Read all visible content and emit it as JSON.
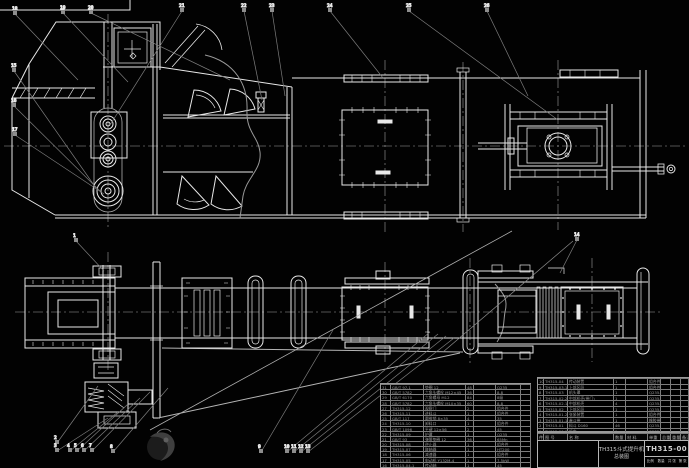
{
  "colors": {
    "background": "#020202",
    "line": "#e8e8e8",
    "dim_line": "#8a8a8a",
    "table_line": "#9a9a9a",
    "text": "#9c9c9c"
  },
  "title_block": {
    "title_line1": "TH315斗式提升机",
    "title_line2": "总装图",
    "drawing_number": "TH315-00",
    "sub_labels": [
      "比例",
      "数量",
      "共 张",
      "第 张"
    ],
    "sig_labels": [
      "标记",
      "设计",
      "制图",
      "审核",
      "处数"
    ]
  },
  "bom_right": {
    "headers": [
      "件",
      "图  号",
      "名    称",
      "数量",
      "材 料",
      "单重",
      "总重",
      "重量",
      "备注"
    ],
    "rows": [
      [
        "10",
        "TH315-04",
        "传动装置",
        "1",
        "",
        "组合件",
        "",
        "",
        ""
      ],
      [
        "9",
        "TH315-03.1",
        "上部区段",
        "1",
        "",
        "组合件",
        "",
        "",
        ""
      ],
      [
        "8",
        "TH315-03",
        "机头罩",
        "1",
        "",
        "Q235-A",
        "",
        "",
        ""
      ],
      [
        "7",
        "TH315-02.2",
        "中部机壳(带门)",
        "1",
        "",
        "Q235-A",
        "",
        "",
        ""
      ],
      [
        "6",
        "TH315-02.1",
        "中部机壳",
        "4",
        "",
        "Q235-A",
        "",
        "",
        ""
      ],
      [
        "5",
        "TH315-02",
        "下部区段",
        "1",
        "",
        "Q235-A",
        "",
        "",
        ""
      ],
      [
        "4",
        "TH315-01.2",
        "张紧装置",
        "1",
        "",
        "组合件",
        "",
        "",
        ""
      ],
      [
        "3",
        "TH315-01.1",
        "畚斗带",
        "1",
        "",
        "橡胶带",
        "",
        "",
        ""
      ],
      [
        "2",
        "TH315-01",
        "料斗 D160",
        "46",
        "",
        "Q235-A",
        "",
        "",
        ""
      ],
      [
        "1",
        "TH315-00.1",
        "机座",
        "1",
        "",
        "Q235-A",
        "",
        "",
        ""
      ]
    ]
  },
  "bom_left": {
    "rows": [
      [
        "31",
        "GB/T 97.1",
        "垫圈 12",
        "48",
        "",
        "Q235",
        ""
      ],
      [
        "30",
        "GB/T 5782",
        "六角头螺栓 M12×45",
        "36",
        "",
        "8.8",
        ""
      ],
      [
        "29",
        "GB/T 6170",
        "六角螺母 M12",
        "84",
        "",
        "8级",
        ""
      ],
      [
        "28",
        "GB/T 5782",
        "六角头螺栓 M10×35",
        "60",
        "",
        "8.8",
        ""
      ],
      [
        "27",
        "TH315-12",
        "观察门",
        "2",
        "",
        "组合件",
        ""
      ],
      [
        "26",
        "TH315-11",
        "进料斗",
        "1",
        "",
        "组合件",
        ""
      ],
      [
        "25",
        "GB/T 117",
        "圆锥销 8×35",
        "4",
        "",
        "35",
        ""
      ],
      [
        "24",
        "TH315-10",
        "卸料口",
        "1",
        "",
        "组合件",
        ""
      ],
      [
        "23",
        "GB/T 1096",
        "平键 12×56",
        "2",
        "",
        "45",
        ""
      ],
      [
        "22",
        "TH315-09",
        "护罩",
        "1",
        "",
        "Q235",
        ""
      ],
      [
        "21",
        "GB/T 93",
        "弹簧垫圈 12",
        "36",
        "",
        "65Mn",
        ""
      ],
      [
        "20",
        "TH315-08",
        "逆止器",
        "1",
        "",
        "组合件",
        ""
      ],
      [
        "19",
        "TH315-07",
        "联轴器",
        "1",
        "",
        "HT200",
        ""
      ],
      [
        "18",
        "TH315-06",
        "减速器",
        "1",
        "",
        "组合件",
        ""
      ],
      [
        "17",
        "TH315-05",
        "电动机 Y132M-4",
        "1",
        "",
        "7.5kW",
        ""
      ],
      [
        "16",
        "TH315-04.1",
        "传动轴",
        "1",
        "",
        "45",
        ""
      ]
    ]
  },
  "callouts": [
    {
      "label": "18",
      "x": 13,
      "y": 11,
      "tx": 78,
      "ty": 80
    },
    {
      "label": "19",
      "x": 61,
      "y": 10,
      "tx": 128,
      "ty": 82
    },
    {
      "label": "20",
      "x": 89,
      "y": 10,
      "tx": 230,
      "ty": 80
    },
    {
      "label": "21",
      "x": 180,
      "y": 8,
      "tx": 110,
      "ty": 125
    },
    {
      "label": "22",
      "x": 242,
      "y": 8,
      "tx": 262,
      "ty": 100
    },
    {
      "label": "23",
      "x": 270,
      "y": 8,
      "tx": 285,
      "ty": 96
    },
    {
      "label": "24",
      "x": 328,
      "y": 8,
      "tx": 383,
      "ty": 78
    },
    {
      "label": "25",
      "x": 407,
      "y": 8,
      "tx": 558,
      "ty": 120
    },
    {
      "label": "26",
      "x": 485,
      "y": 8,
      "tx": 528,
      "ty": 96
    },
    {
      "label": "15",
      "x": 12,
      "y": 68,
      "tx": 96,
      "ty": 188
    },
    {
      "label": "16",
      "x": 12,
      "y": 103,
      "tx": 100,
      "ty": 191
    },
    {
      "label": "17",
      "x": 13,
      "y": 132,
      "tx": 104,
      "ty": 194
    },
    {
      "label": "1",
      "x": 74,
      "y": 238,
      "tx": 104,
      "ty": 271
    },
    {
      "label": "2",
      "x": 55,
      "y": 440,
      "tx": 98,
      "ty": 386
    },
    {
      "label": "3",
      "x": 55,
      "y": 448,
      "tx": 108,
      "ty": 418
    },
    {
      "label": "4",
      "x": 68,
      "y": 448,
      "tx": 118,
      "ty": 412
    },
    {
      "label": "5",
      "x": 75,
      "y": 448,
      "tx": 128,
      "ty": 404
    },
    {
      "label": "6",
      "x": 82,
      "y": 448,
      "tx": 140,
      "ty": 398
    },
    {
      "label": "7",
      "x": 90,
      "y": 448,
      "tx": 150,
      "ty": 392
    },
    {
      "label": "8",
      "x": 111,
      "y": 449,
      "tx": 168,
      "ty": 388
    },
    {
      "label": "9",
      "x": 259,
      "y": 449,
      "tx": 333,
      "ty": 330
    },
    {
      "label": "10",
      "x": 285,
      "y": 449,
      "tx": 430,
      "ty": 332
    },
    {
      "label": "11",
      "x": 292,
      "y": 449,
      "tx": 438,
      "ty": 334
    },
    {
      "label": "12",
      "x": 299,
      "y": 449,
      "tx": 446,
      "ty": 336
    },
    {
      "label": "13",
      "x": 306,
      "y": 449,
      "tx": 454,
      "ty": 338
    },
    {
      "label": "14",
      "x": 575,
      "y": 237,
      "tx": 560,
      "ty": 273
    }
  ]
}
